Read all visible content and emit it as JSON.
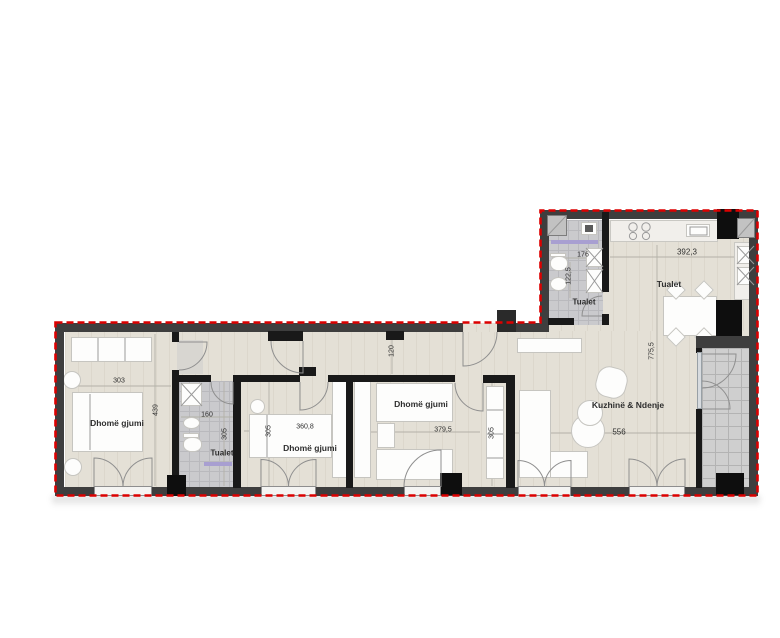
{
  "colors": {
    "boundary": "#dc0000",
    "wall": "#3e3e3e",
    "partition": "#191919",
    "floor_wood": "#e4e0d6",
    "floor_tile": "#cacacd",
    "accent_lavender": "#a89fd1"
  },
  "rooms": {
    "bedroom1": {
      "label": "Dhomë gjumi",
      "width": "303",
      "depth": "439"
    },
    "toilet1": {
      "label": "Tualet",
      "width": "160",
      "depth": "305"
    },
    "bedroom2": {
      "label": "Dhomë gjumi",
      "width": "360,8",
      "depth": "305"
    },
    "bedroom3": {
      "label": "Dhomë gjumi",
      "width": "379,5",
      "depth": "305"
    },
    "living": {
      "label": "Kuzhinë & Ndenje",
      "width": "556",
      "depth": "775,5"
    },
    "toilet2": {
      "label": "Tualet",
      "width": "176",
      "depth": "122,5"
    },
    "kitchen_zone": {
      "label": "Tualet",
      "width": "392,3"
    },
    "corridor": {
      "depth": "120"
    }
  }
}
